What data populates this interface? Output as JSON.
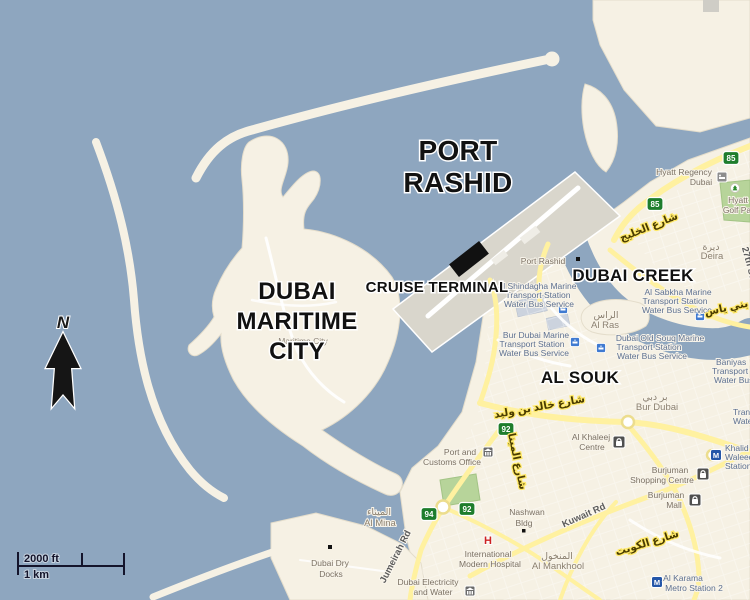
{
  "annotations": {
    "port_rashid": [
      "PORT",
      "RASHID"
    ],
    "maritime_city": [
      "DUBAI",
      "MARITIME",
      "CITY"
    ],
    "cruise_terminal": "CRUISE TERMINAL",
    "dubai_creek": "DUBAI CREEK",
    "al_souk": "AL SOUK",
    "north_arrow": "N"
  },
  "scale_bar": {
    "imperial": "2000 ft",
    "metric": "1 km"
  },
  "route_shields": [
    "85",
    "85",
    "94",
    "92",
    "92"
  ],
  "districts": {
    "deira": {
      "ar": "ديرة",
      "en": "Deira"
    },
    "al_ras": {
      "ar": "الراس",
      "en": "Al Ras"
    },
    "bur_dubai": {
      "ar": "بر دبي",
      "en": "Bur Dubai"
    },
    "al_mankhool": {
      "ar": "المنخول",
      "en": "Al Mankhool"
    },
    "al_mina": {
      "ar": "الميناء",
      "en": "Al Mina"
    }
  },
  "places": {
    "port_rashid_small": "Port Rashid",
    "maritime_city_small": "Maritime City",
    "hyatt_regency": [
      "Hyatt Regency",
      "Dubai"
    ],
    "hyatt_golf": [
      "Hyatt",
      "Golf Pa"
    ],
    "shindagha_station": [
      "Al Shindagha Marine",
      "Transport Station",
      "Water Bus Service"
    ],
    "sabkha_station": [
      "Al Sabkha Marine",
      "Transport Station",
      "Water Bus Service"
    ],
    "bur_dubai_station": [
      "Bur Dubai Marine",
      "Transport Station",
      "Water Bus Service"
    ],
    "old_souq_station": [
      "Dubai Old Souq Marine",
      "Transport Station",
      "Water Bus Service"
    ],
    "baniyas_station": [
      "Baniyas",
      "Transport",
      "Water Bus"
    ],
    "edge_station": [
      "Transport",
      "Water Bus"
    ],
    "khalid_station": [
      "Khalid",
      "Waleed",
      "Station"
    ],
    "al_karama_station": [
      "Al Karama",
      "Metro Station 2"
    ],
    "khaleej_centre": [
      "Al Khaleej",
      "Centre"
    ],
    "burjuman_centre": [
      "Burjuman",
      "Shopping Centre"
    ],
    "burjuman_mall": [
      "Burjuman",
      "Mall"
    ],
    "port_customs": [
      "Port and",
      "Customs Office"
    ],
    "nashwan": [
      "Nashwan",
      "Bldg"
    ],
    "hospital": [
      "International",
      "Modern Hospital"
    ],
    "dewa": [
      "Dubai Electricity",
      "and Water"
    ],
    "dry_docks": [
      "Dubai Dry",
      "Docks"
    ]
  },
  "roads": {
    "khaleej_ar": "شارع الخليج",
    "baniyas_ar": "بني ياس",
    "khalid_bin_waleed_ar": "شارع خالد بن وليد",
    "kuwait_en": "Kuwait Rd",
    "kuwait_ar": "شارع الكويت",
    "mina_ar": "شارع المينا",
    "jumeirah": "Jumeirah Rd",
    "street_27": "27th St"
  },
  "icons": {
    "metro": "M",
    "hospital": "H"
  },
  "colors": {
    "sea": "#8ea6bf",
    "land": "#f6f1e4",
    "pier": "#d9d6cc",
    "road": "#fff1a0",
    "green": "#b7d49a",
    "annotation": "#111111",
    "marker": "#111111",
    "shield": "#1e7d2c"
  }
}
